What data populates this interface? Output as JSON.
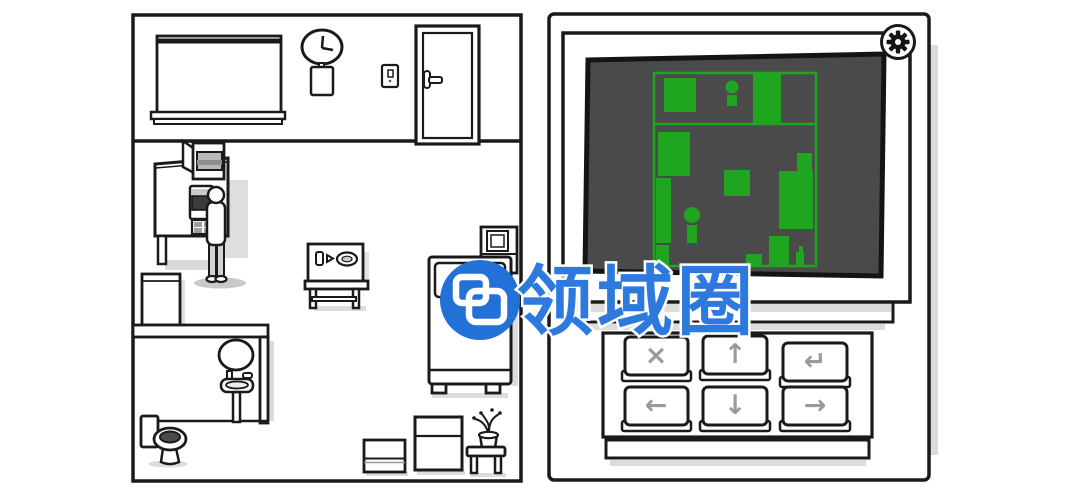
{
  "watermark": {
    "text": "领域圈",
    "logo_icon": "overlapping-rounded-squares-logo",
    "circle_color": "#2171d6",
    "text_color": "#2e79dd"
  },
  "room": {
    "clock_time": "3:00",
    "objects": [
      "window-blind",
      "wall-clock",
      "notepad",
      "light-switch",
      "door",
      "wall-cabinet",
      "kitchen-unit",
      "microwave",
      "drawer-unit",
      "man",
      "fridge-box",
      "bathroom-wall",
      "mirror",
      "sink",
      "toilet",
      "radio-table",
      "bed",
      "bedside-cabinet",
      "storage-box",
      "dresser",
      "plant-stool"
    ]
  },
  "device": {
    "gear_icon": "settings-gear",
    "screen": {
      "bg": "#4a4a4a",
      "map_color": "#20a520",
      "outline": {
        "x": 654,
        "y": 73,
        "w": 162,
        "h": 193
      },
      "divider_y": 124,
      "shapes": [
        {
          "type": "rect",
          "x": 664,
          "y": 78,
          "w": 32,
          "h": 34
        },
        {
          "type": "person",
          "cx": 732,
          "cy": 87,
          "r": 6.5,
          "bx": 727,
          "by": 95,
          "bw": 10,
          "bh": 11
        },
        {
          "type": "rect",
          "x": 753,
          "y": 74,
          "w": 28,
          "h": 51
        },
        {
          "type": "rect",
          "x": 658,
          "y": 132,
          "w": 32,
          "h": 44
        },
        {
          "type": "rect",
          "x": 656,
          "y": 178,
          "w": 15,
          "h": 65
        },
        {
          "type": "person",
          "cx": 692,
          "cy": 215,
          "r": 8,
          "bx": 687,
          "by": 225,
          "bw": 10,
          "bh": 18
        },
        {
          "type": "rect",
          "x": 656,
          "y": 245,
          "w": 13,
          "h": 21
        },
        {
          "type": "rect",
          "x": 724,
          "y": 170,
          "w": 26,
          "h": 26
        },
        {
          "type": "rect",
          "x": 779,
          "y": 171,
          "w": 34,
          "h": 58
        },
        {
          "type": "rect",
          "x": 797,
          "y": 153,
          "w": 15,
          "h": 18
        },
        {
          "type": "rect",
          "x": 746,
          "y": 254,
          "w": 16,
          "h": 11
        },
        {
          "type": "rect",
          "x": 769,
          "y": 236,
          "w": 20,
          "h": 30
        },
        {
          "type": "rect",
          "x": 796,
          "y": 252,
          "w": 8,
          "h": 13
        },
        {
          "type": "rect",
          "x": 799,
          "y": 246,
          "w": 4,
          "h": 6
        }
      ]
    },
    "keypad": {
      "keys": [
        {
          "name": "cancel",
          "glyph": "×"
        },
        {
          "name": "up",
          "glyph": "↑"
        },
        {
          "name": "enter",
          "glyph": "↵"
        },
        {
          "name": "left",
          "glyph": "←"
        },
        {
          "name": "down",
          "glyph": "↓"
        },
        {
          "name": "right",
          "glyph": "→"
        }
      ]
    }
  },
  "colors": {
    "line_art": "#1a1a1a",
    "screen_bg": "#4a4a4a",
    "map_green": "#20a520",
    "key_glyph_gray": "#9a9a9a",
    "watermark_blue": "#2171d6",
    "shadow_gray": "#dcdcdc"
  }
}
